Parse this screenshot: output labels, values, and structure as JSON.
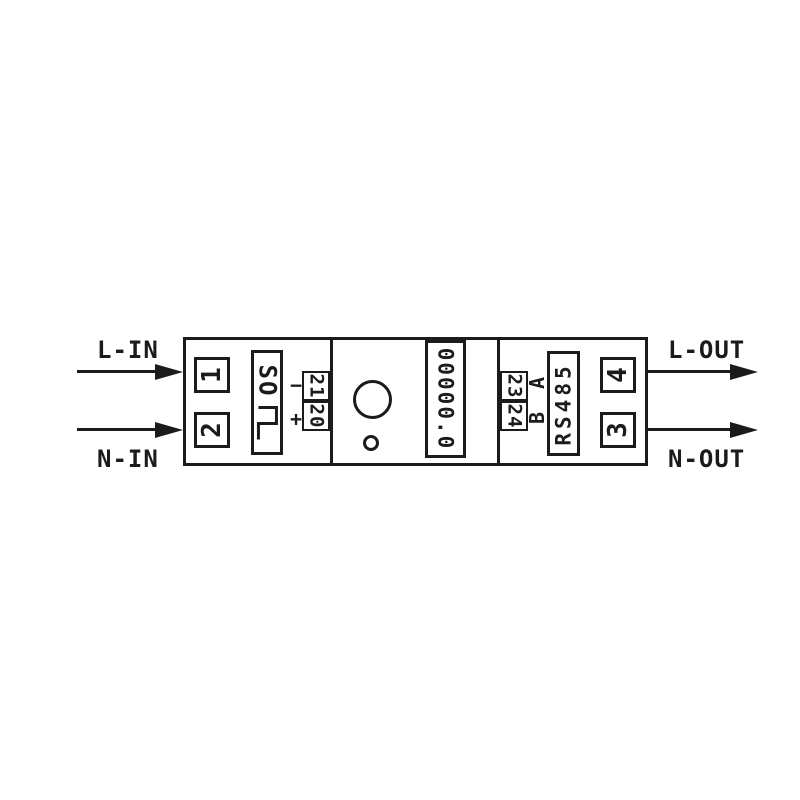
{
  "labels": {
    "line_in": "L-IN",
    "neutral_in": "N-IN",
    "line_out": "L-OUT",
    "neutral_out": "N-OUT"
  },
  "terminals": {
    "t1": "1",
    "t2": "2",
    "t3": "3",
    "t4": "4"
  },
  "pulse": {
    "label": "SO",
    "minus": "−",
    "plus": "+",
    "terminal_21": "21",
    "terminal_20": "20"
  },
  "display": {
    "value": "00000.0"
  },
  "comm": {
    "label": "RS485",
    "a": "A",
    "b": "B",
    "terminal_23": "23",
    "terminal_24": "24"
  },
  "colors": {
    "ink": "#1b1b1b",
    "background": "#ffffff"
  }
}
